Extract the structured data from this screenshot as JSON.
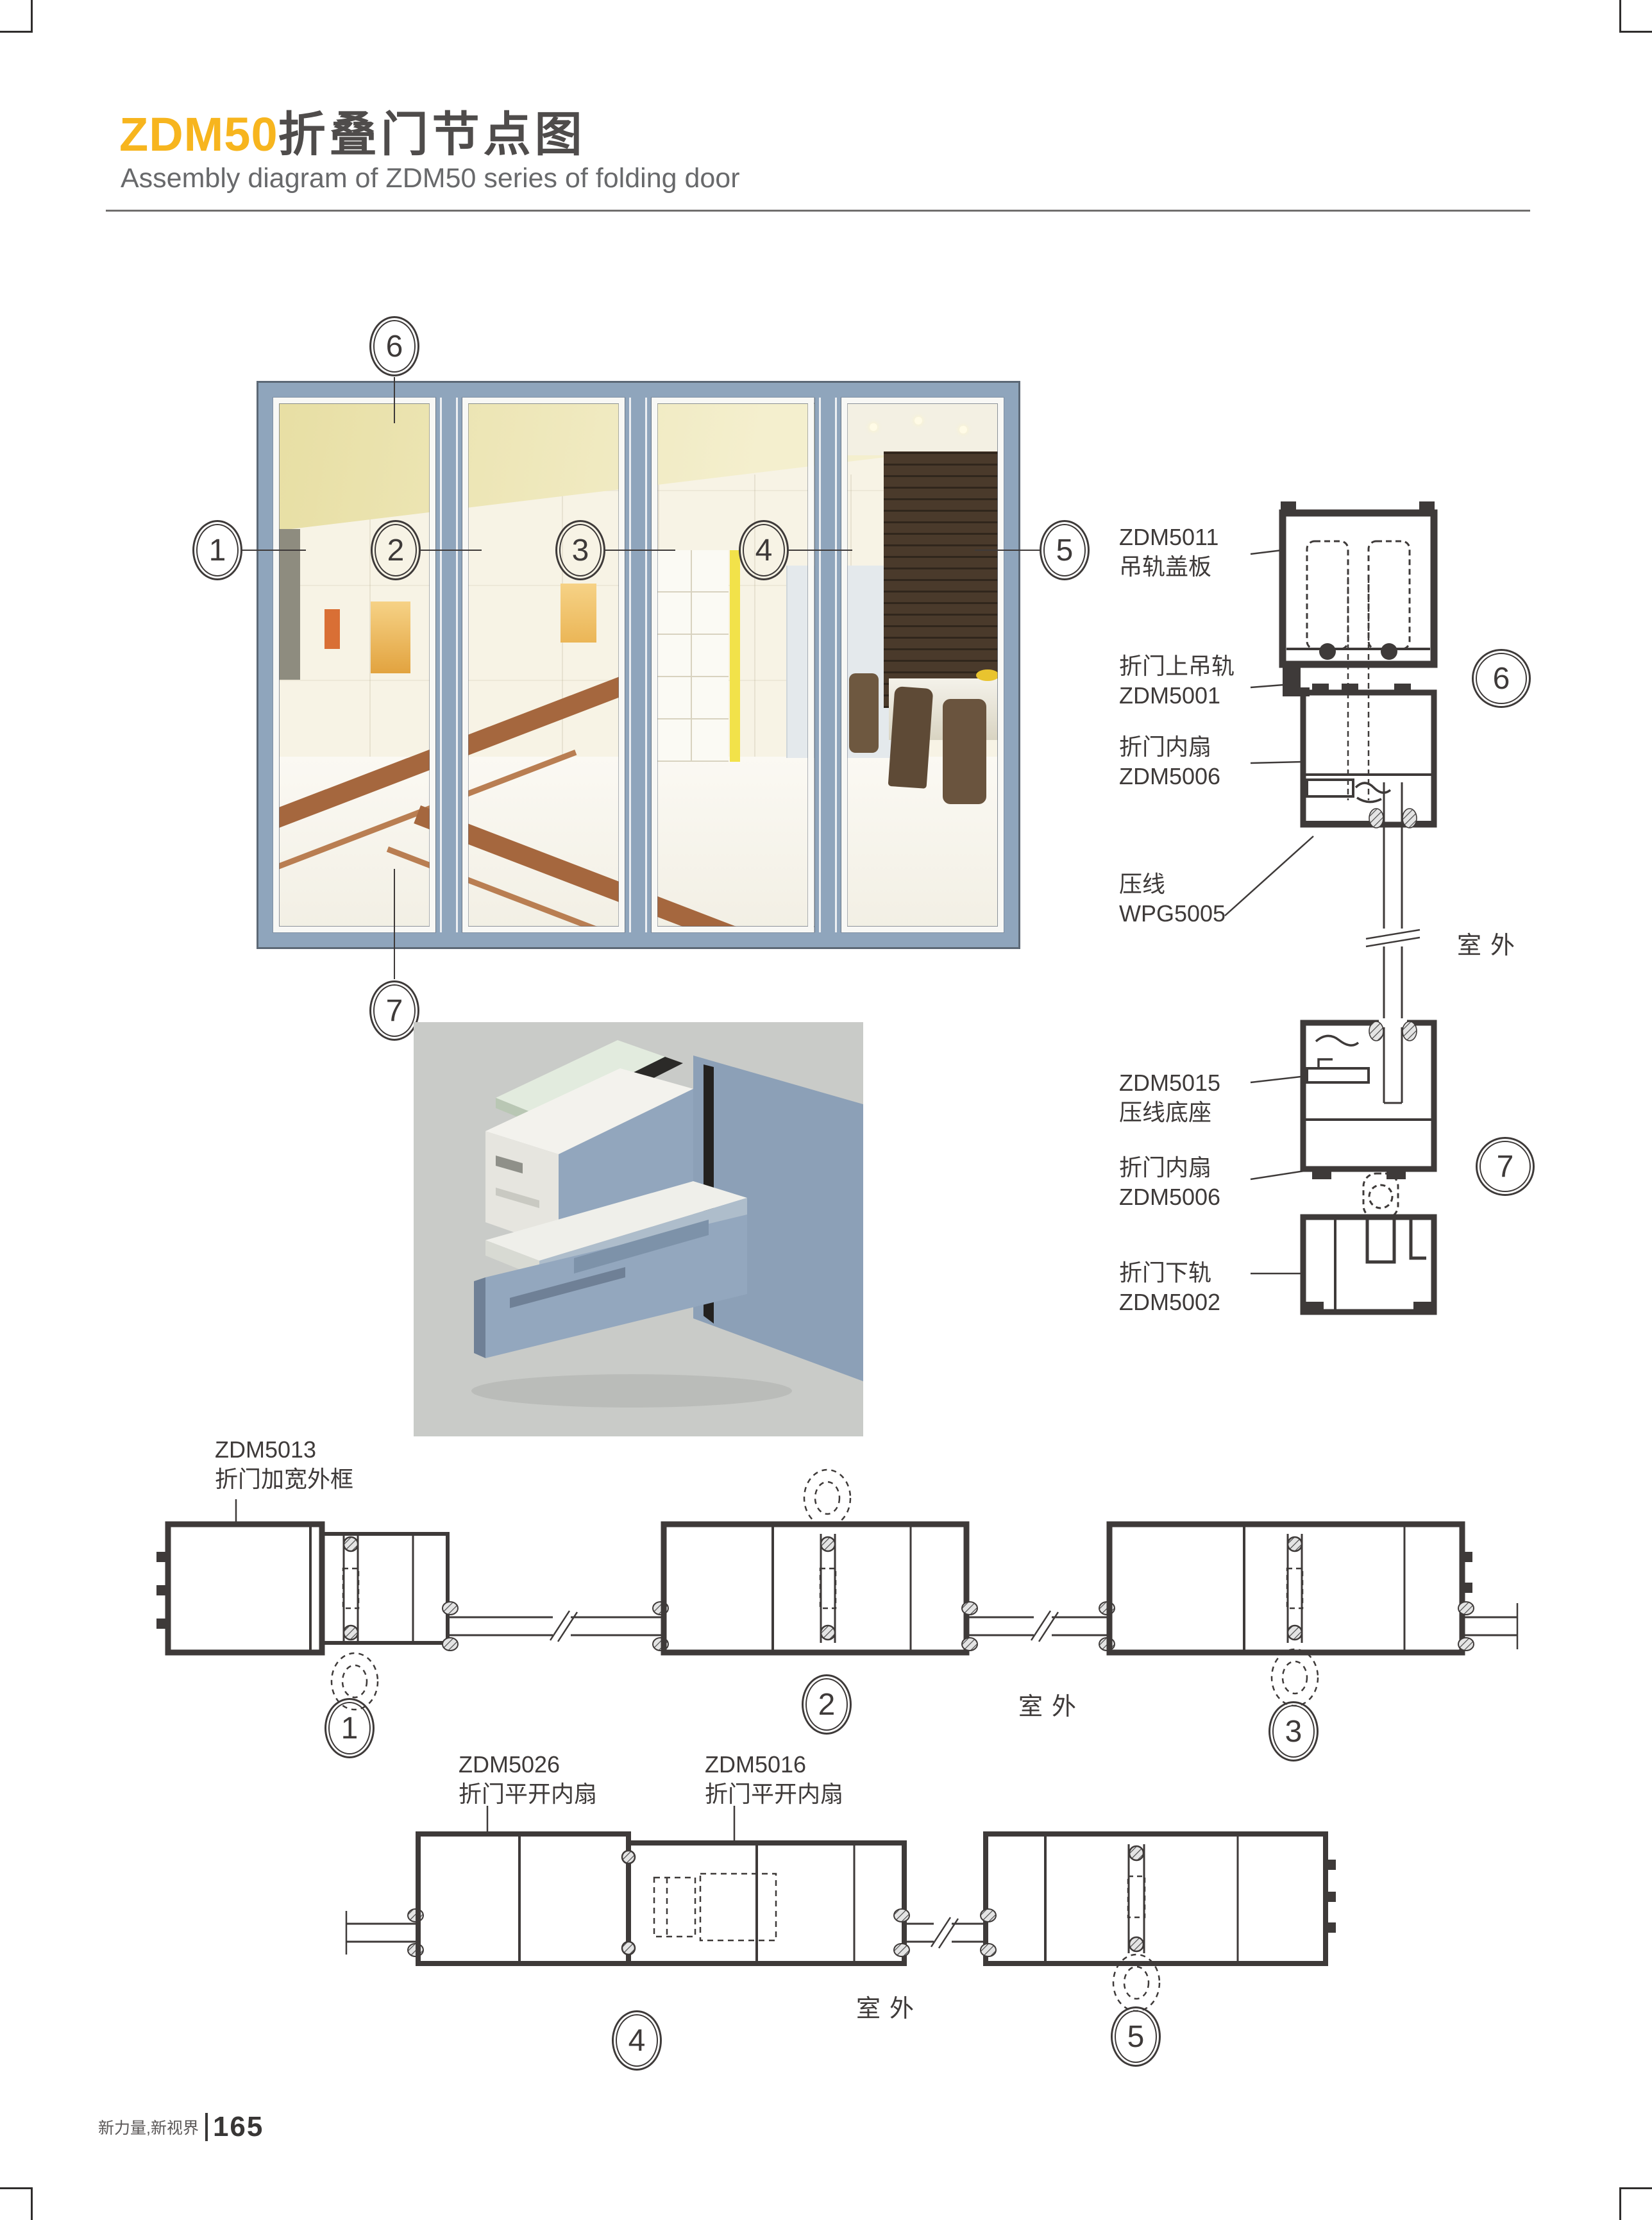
{
  "colors": {
    "accent_yellow": "#F7B51E",
    "ink": "#3E3A39",
    "frame_blue": "#8FA5BC",
    "render_bg": "#C9CBC8"
  },
  "header": {
    "title_highlight": "ZDM50",
    "title_rest": "折叠门节点图",
    "subtitle": "Assembly diagram of ZDM50 series of folding door"
  },
  "callouts": [
    "1",
    "2",
    "3",
    "4",
    "5",
    "6",
    "7"
  ],
  "vsec": {
    "labels": [
      {
        "line1": "ZDM5011",
        "line2": "吊轨盖板"
      },
      {
        "line1": "折门上吊轨",
        "line2": "ZDM5001"
      },
      {
        "line1": "折门内扇",
        "line2": "ZDM5006"
      },
      {
        "line1": "压线",
        "line2": "WPG5005"
      },
      {
        "line1": "ZDM5015",
        "line2": "压线底座"
      },
      {
        "line1": "折门内扇",
        "line2": "ZDM5006"
      },
      {
        "line1": "折门下轨",
        "line2": "ZDM5002"
      }
    ],
    "outdoor": "室外"
  },
  "row1": {
    "label": {
      "line1": "ZDM5013",
      "line2": "折门加宽外框"
    },
    "outdoor": "室外"
  },
  "row2": {
    "labels": [
      {
        "line1": "ZDM5026",
        "line2": "折门平开内扇"
      },
      {
        "line1": "ZDM5016",
        "line2": "折门平开内扇"
      }
    ],
    "outdoor": "室外"
  },
  "footer": {
    "brand": "新力量,新视界",
    "page_number": "165"
  }
}
